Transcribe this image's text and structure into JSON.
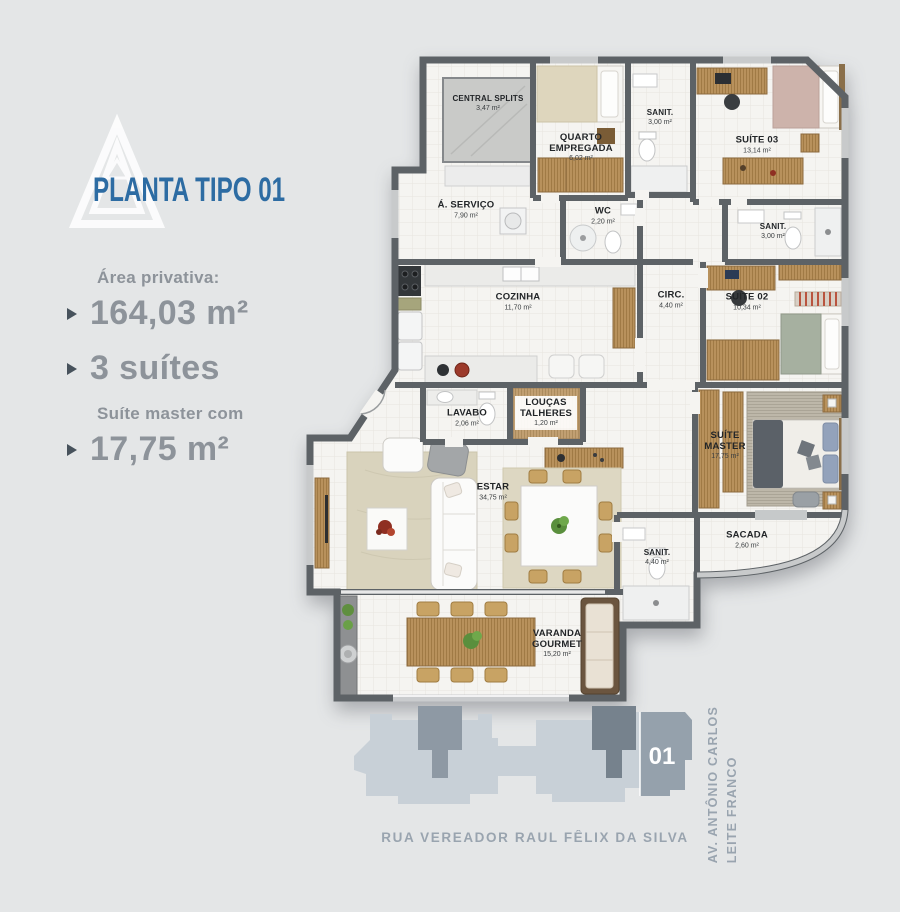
{
  "branding": {
    "title": "PLANTA TIPO 01"
  },
  "stats": {
    "area_label": "Área privativa:",
    "area_value": "164,03 m²",
    "suites_value": "3 suítes",
    "master_label": "Suíte master com",
    "master_value": "17,75 m²"
  },
  "floorplan": {
    "rooms": [
      {
        "name": "CENTRAL SPLITS",
        "area": "3,47 m²"
      },
      {
        "name": "QUARTO EMPREGADA",
        "area": "6,02 m²"
      },
      {
        "name": "SANIT.",
        "area": "3,00 m²"
      },
      {
        "name": "SUÍTE 03",
        "area": "13,14 m²"
      },
      {
        "name": "Á. SERVIÇO",
        "area": "7,90 m²"
      },
      {
        "name": "WC",
        "area": "2,20 m²"
      },
      {
        "name": "SANIT.",
        "area": "3,00 m²"
      },
      {
        "name": "COZINHA",
        "area": "11,70 m²"
      },
      {
        "name": "CIRC.",
        "area": "4,40 m²"
      },
      {
        "name": "SUÍTE 02",
        "area": "10,34 m²"
      },
      {
        "name": "LAVABO",
        "area": "2,06 m²"
      },
      {
        "name": "LOUÇAS TALHERES",
        "area": "1,20 m²"
      },
      {
        "name": "SUÍTE MASTER",
        "area": "17,75 m²"
      },
      {
        "name": "ESTAR",
        "area": "34,75 m²"
      },
      {
        "name": "SACADA",
        "area": "2,60 m²"
      },
      {
        "name": "SANIT.",
        "area": "4,40 m²"
      },
      {
        "name": "VARANDA GOURMET",
        "area": "15,20 m²"
      }
    ]
  },
  "siteplan": {
    "unit_label": "01",
    "street_bottom": "RUA VEREADOR RAUL FÊLIX DA SILVA",
    "street_right_line1": "AV. ANTÔNIO CARLOS",
    "street_right_line2": "LEITE FRANCO"
  },
  "colors": {
    "title_blue": "#2d6ca3",
    "stats_gray": "#8d939a",
    "wall_gray": "#5d6266",
    "background": "#e4e6e7",
    "wood": "#b8915c",
    "siteplan_light": "#c8d0d7",
    "siteplan_highlight": "#95a1ac",
    "siteplan_core": "#76828d",
    "street_text": "#8d99a6"
  }
}
